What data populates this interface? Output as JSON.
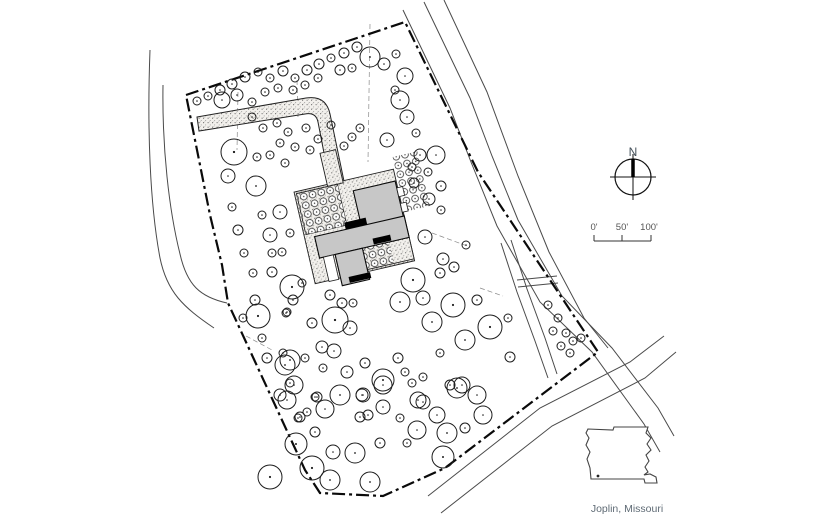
{
  "annotations": {
    "north_label": "N",
    "scale_labels": [
      "0'",
      "50'",
      "100'"
    ],
    "location_label": "Joplin, Missouri"
  },
  "colors": {
    "line": "#1c1c1c",
    "building_fill": "#c7c7c7",
    "accent_fill": "#000000",
    "label_gray": "#5f6b75",
    "background": "#ffffff"
  },
  "north_arrow": {
    "cx": 633,
    "cy": 177,
    "r": 18,
    "tick": 5,
    "bar_w": 3.5
  },
  "scale_bar": {
    "x1": 594,
    "x2": 651,
    "y": 241,
    "mid": 622,
    "tick_h": 6
  },
  "state_map": {
    "path": "M 588,429 L 613,430 L 614,427 L 648,427 L 646,433 L 651,438 L 647,444 L 651,450 L 646,455 L 649,461 L 645,467 L 648,472 L 644,475 L 650,474 L 656,477 L 657,483 L 645,483 L 644,479 L 591,479 L 590,468 L 587,459 L 590,452 L 586,445 L 589,438 L 586,433 Z",
    "dot": [
      598,
      476
    ]
  },
  "plan": {
    "boundary": "M 186,95 L 405,22 L 478,172 L 598,352 L 445,468 L 383,496 L 320,493 L 305,470 L 293,444 L 228,303 L 222,265 L 210,215 Z",
    "roads": [
      "M 403,10 L 450,108 L 471,162 L 497,226 L 540,302 L 592,352 L 644,424 L 660,452",
      "M 424,2 L 470,98 L 492,156 L 518,220 L 562,296 L 612,348 L 658,408 L 674,436",
      "M 444,0 L 487,92 L 518,176 L 549,252 L 584,318 L 608,348",
      "M 664,336 L 630,362 L 540,408 L 428,496",
      "M 676,352 L 645,378 L 552,426 L 441,513",
      "M 150,50 C 147,130 150,205 160,258 C 167,292 183,307 214,328",
      "M 163,85 C 162,148 169,210 180,254 C 187,285 200,297 227,303",
      "M 501,243 L 517,292 L 535,341 L 548,378",
      "M 511,240 L 527,289 L 545,338 L 557,374",
      "M 517,280 L 557,276",
      "M 518,287 L 558,283"
    ],
    "leaders": [
      "M 238,92 L 237,150",
      "M 370,24 L 368,162",
      "M 432,233 L 470,247",
      "M 480,288 L 503,296",
      "M 246,336 L 272,350",
      "M 297,80 L 298,118"
    ],
    "driveway": "M 197,117 L 306,98 Q 326,95 330,114 L 345,186 L 331,189 L 318,122 Q 316,112 305,114 L 199,131 Z",
    "plaza": {
      "rotation": -13,
      "pivot": [
        360,
        220
      ],
      "base": [
        302,
        178,
        102,
        94
      ],
      "column": [
        336,
        146,
        16,
        34
      ],
      "bed_stip": [
        [
          304,
          180,
          42,
          42
        ],
        [
          352,
          240,
          52,
          30
        ]
      ],
      "bed_shrubs": [
        [
          304,
          180,
          42,
          42
        ],
        [
          352,
          240,
          31,
          30
        ]
      ],
      "hedge": [
        406,
        166,
        26,
        56
      ],
      "building": [
        [
          360,
          190,
          43,
          44
        ],
        [
          312,
          226,
          92,
          22
        ],
        [
          328,
          248,
          28,
          32
        ]
      ],
      "accents": [
        [
          344,
          219,
          22,
          7
        ],
        [
          368,
          241,
          18,
          6
        ],
        [
          336,
          273,
          22,
          6
        ]
      ],
      "walks": [
        [
          316,
          248,
          10,
          25
        ],
        [
          403,
          197,
          6,
          9
        ],
        [
          403,
          213,
          6,
          9
        ]
      ]
    },
    "trees": [
      [
        197,
        101,
        4
      ],
      [
        208,
        96,
        4
      ],
      [
        220,
        90,
        5
      ],
      [
        232,
        84,
        5
      ],
      [
        245,
        77,
        5
      ],
      [
        258,
        72,
        4
      ],
      [
        270,
        78,
        4
      ],
      [
        283,
        71,
        5
      ],
      [
        295,
        78,
        4
      ],
      [
        307,
        70,
        5
      ],
      [
        319,
        64,
        5
      ],
      [
        331,
        58,
        4
      ],
      [
        344,
        53,
        5
      ],
      [
        357,
        47,
        5
      ],
      [
        370,
        57,
        10
      ],
      [
        384,
        64,
        6
      ],
      [
        396,
        54,
        4
      ],
      [
        405,
        76,
        8
      ],
      [
        222,
        100,
        8
      ],
      [
        237,
        95,
        6
      ],
      [
        252,
        102,
        4
      ],
      [
        265,
        92,
        4
      ],
      [
        278,
        88,
        4
      ],
      [
        293,
        90,
        4
      ],
      [
        305,
        85,
        4
      ],
      [
        318,
        78,
        4
      ],
      [
        340,
        70,
        5
      ],
      [
        352,
        68,
        4
      ],
      [
        400,
        100,
        9
      ],
      [
        407,
        117,
        7
      ],
      [
        395,
        90,
        4
      ],
      [
        387,
        140,
        7
      ],
      [
        416,
        133,
        4
      ],
      [
        420,
        155,
        6
      ],
      [
        436,
        155,
        9
      ],
      [
        428,
        172,
        4
      ],
      [
        412,
        167,
        4
      ],
      [
        441,
        186,
        5
      ],
      [
        414,
        183,
        5
      ],
      [
        429,
        199,
        6
      ],
      [
        441,
        210,
        4
      ],
      [
        425,
        237,
        7
      ],
      [
        466,
        245,
        4
      ],
      [
        443,
        259,
        6
      ],
      [
        454,
        267,
        5
      ],
      [
        234,
        152,
        13
      ],
      [
        256,
        186,
        10
      ],
      [
        228,
        176,
        7
      ],
      [
        252,
        117,
        4
      ],
      [
        263,
        128,
        4
      ],
      [
        277,
        123,
        4
      ],
      [
        288,
        132,
        4
      ],
      [
        280,
        143,
        4
      ],
      [
        295,
        147,
        4
      ],
      [
        270,
        155,
        4
      ],
      [
        285,
        163,
        4
      ],
      [
        257,
        157,
        4
      ],
      [
        238,
        230,
        5
      ],
      [
        244,
        253,
        4
      ],
      [
        232,
        207,
        4
      ],
      [
        262,
        215,
        4
      ],
      [
        280,
        212,
        7
      ],
      [
        270,
        235,
        7
      ],
      [
        290,
        233,
        4
      ],
      [
        282,
        252,
        4
      ],
      [
        272,
        253,
        4
      ],
      [
        253,
        273,
        4
      ],
      [
        272,
        272,
        5
      ],
      [
        293,
        300,
        5
      ],
      [
        255,
        300,
        5
      ],
      [
        243,
        318,
        4
      ],
      [
        258,
        316,
        12
      ],
      [
        262,
        338,
        4
      ],
      [
        267,
        358,
        5
      ],
      [
        287,
        312,
        4
      ],
      [
        283,
        353,
        4
      ],
      [
        285,
        365,
        10
      ],
      [
        294,
        385,
        9
      ],
      [
        287,
        400,
        9
      ],
      [
        307,
        412,
        4
      ],
      [
        306,
        128,
        4
      ],
      [
        318,
        139,
        4
      ],
      [
        331,
        125,
        4
      ],
      [
        344,
        146,
        4
      ],
      [
        310,
        150,
        4
      ],
      [
        352,
        137,
        4
      ],
      [
        360,
        128,
        4
      ],
      [
        292,
        287,
        12
      ],
      [
        302,
        283,
        4
      ],
      [
        330,
        295,
        5
      ],
      [
        342,
        303,
        5
      ],
      [
        353,
        303,
        4
      ],
      [
        335,
        320,
        13
      ],
      [
        350,
        328,
        7
      ],
      [
        312,
        323,
        5
      ],
      [
        286,
        313,
        4
      ],
      [
        322,
        347,
        6
      ],
      [
        334,
        351,
        7
      ],
      [
        290,
        360,
        10
      ],
      [
        305,
        358,
        4
      ],
      [
        323,
        368,
        4
      ],
      [
        347,
        372,
        6
      ],
      [
        365,
        363,
        5
      ],
      [
        383,
        380,
        11
      ],
      [
        362,
        395,
        6
      ],
      [
        315,
        397,
        4
      ],
      [
        325,
        409,
        9
      ],
      [
        300,
        417,
        5
      ],
      [
        360,
        417,
        5
      ],
      [
        383,
        407,
        7
      ],
      [
        398,
        358,
        5
      ],
      [
        405,
        372,
        4
      ],
      [
        418,
        400,
        8
      ],
      [
        423,
        377,
        4
      ],
      [
        413,
        280,
        12
      ],
      [
        423,
        298,
        7
      ],
      [
        440,
        273,
        5
      ],
      [
        400,
        302,
        10
      ],
      [
        432,
        322,
        10
      ],
      [
        453,
        305,
        12
      ],
      [
        465,
        340,
        10
      ],
      [
        440,
        353,
        4
      ],
      [
        457,
        388,
        10
      ],
      [
        437,
        415,
        8
      ],
      [
        465,
        428,
        5
      ],
      [
        477,
        300,
        5
      ],
      [
        490,
        327,
        12
      ],
      [
        510,
        357,
        5
      ],
      [
        508,
        318,
        4
      ],
      [
        280,
        395,
        6
      ],
      [
        290,
        383,
        4
      ],
      [
        317,
        397,
        5
      ],
      [
        340,
        395,
        10
      ],
      [
        363,
        395,
        7
      ],
      [
        383,
        385,
        9
      ],
      [
        412,
        383,
        4
      ],
      [
        423,
        402,
        7
      ],
      [
        450,
        385,
        5
      ],
      [
        462,
        385,
        8
      ],
      [
        477,
        395,
        9
      ],
      [
        368,
        415,
        5
      ],
      [
        400,
        418,
        4
      ],
      [
        315,
        432,
        5
      ],
      [
        298,
        418,
        4
      ],
      [
        417,
        430,
        9
      ],
      [
        447,
        433,
        10
      ],
      [
        483,
        415,
        9
      ],
      [
        380,
        443,
        5
      ],
      [
        333,
        452,
        7
      ],
      [
        355,
        453,
        10
      ],
      [
        312,
        468,
        12
      ],
      [
        330,
        480,
        10
      ],
      [
        370,
        482,
        10
      ],
      [
        407,
        443,
        4
      ],
      [
        443,
        457,
        11
      ],
      [
        270,
        477,
        12
      ],
      [
        296,
        444,
        11
      ],
      [
        548,
        305,
        4
      ],
      [
        558,
        318,
        4
      ],
      [
        553,
        331,
        4
      ],
      [
        566,
        333,
        4
      ],
      [
        573,
        341,
        4
      ],
      [
        581,
        338,
        4
      ],
      [
        561,
        346,
        4
      ],
      [
        570,
        353,
        4
      ]
    ]
  }
}
